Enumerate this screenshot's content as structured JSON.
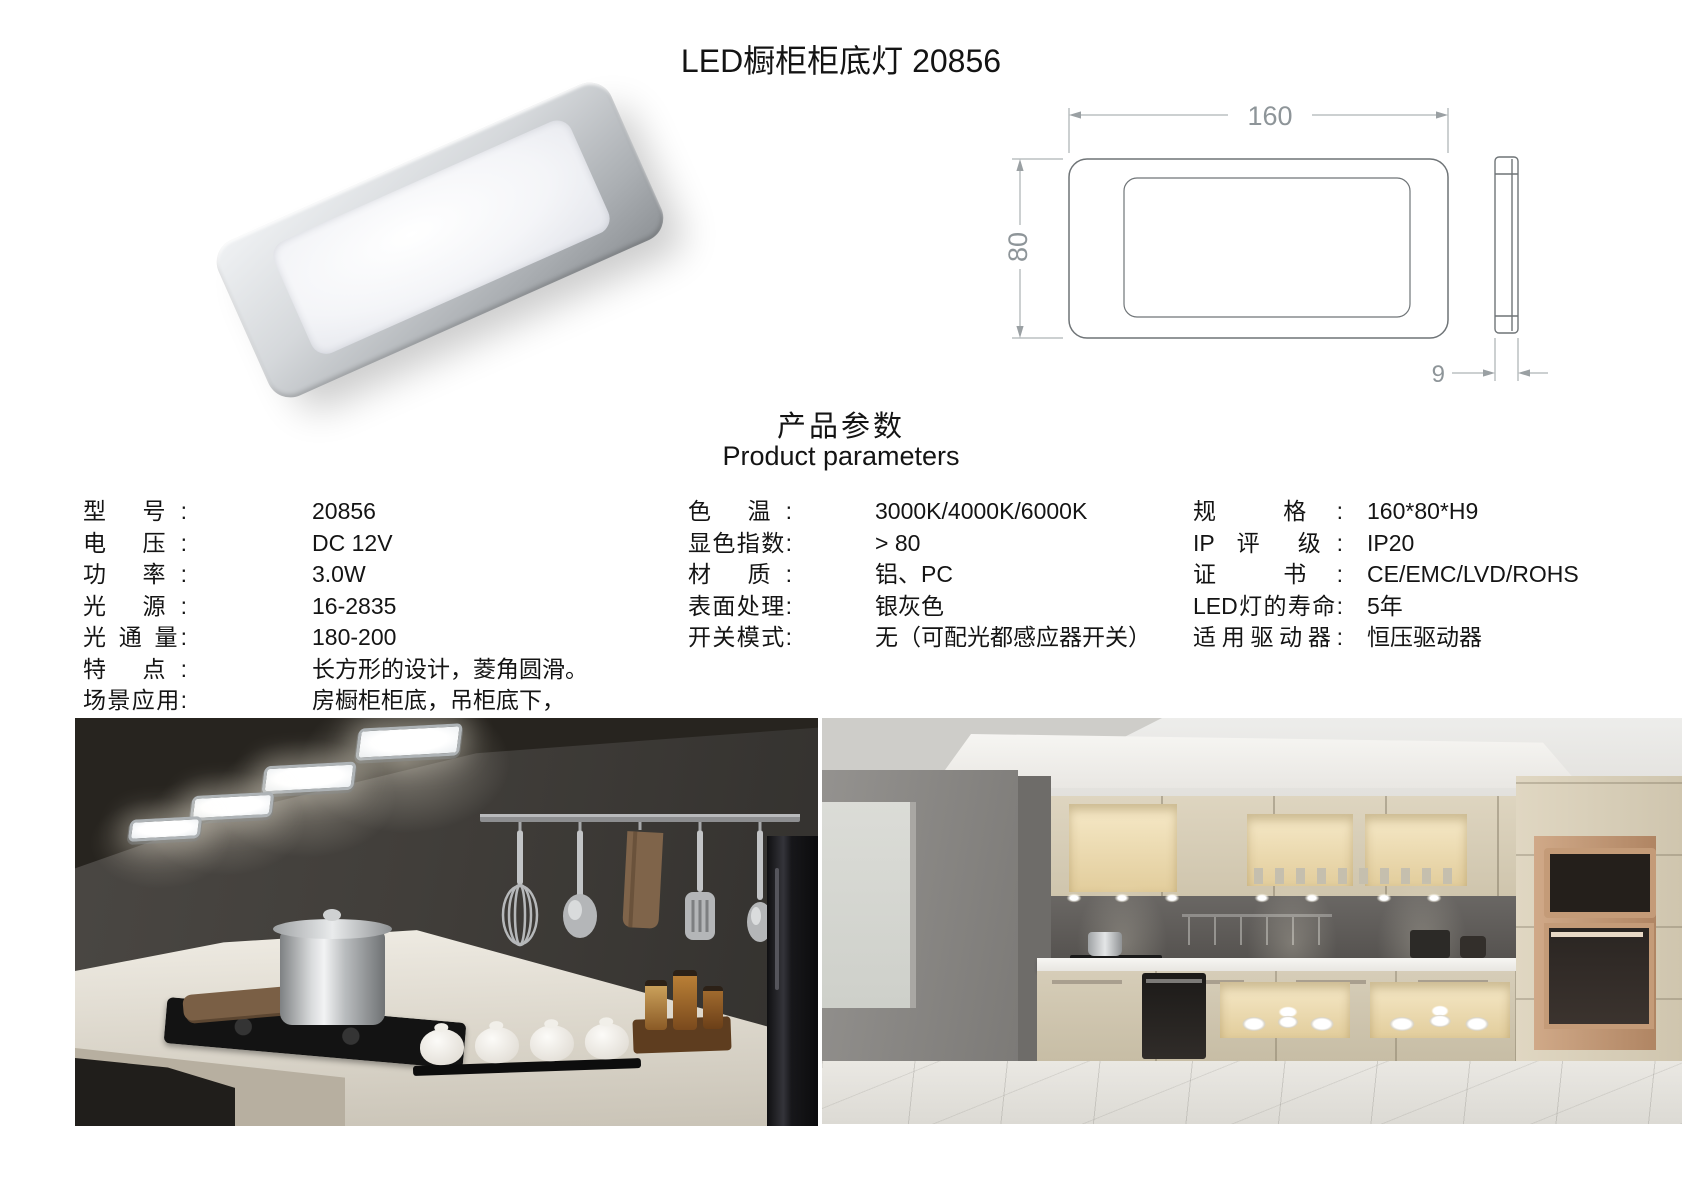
{
  "title": "LED橱柜柜底灯 20856",
  "section": {
    "heading_zh": "产品参数",
    "heading_en": "Product parameters"
  },
  "drawing": {
    "width_dim": "160",
    "height_dim": "80",
    "thickness_dim": "9"
  },
  "specs": {
    "col1": [
      {
        "label": "型 号:",
        "value": "20856"
      },
      {
        "label": "电 压:",
        "value": "DC 12V"
      },
      {
        "label": "功 率:",
        "value": "3.0W"
      },
      {
        "label": "光 源:",
        "value": "16-2835"
      },
      {
        "label": "光 通 量:",
        "value": "180-200"
      },
      {
        "label": "特 点:",
        "value": "长方形的设计，菱角圆滑。"
      },
      {
        "label": "场景应用:",
        "value": "房橱柜柜底，吊柜底下，"
      }
    ],
    "col2": [
      {
        "label": "色 温:",
        "value": "3000K/4000K/6000K"
      },
      {
        "label": "显色指数:",
        "value": "> 80"
      },
      {
        "label": "材 质:",
        "value": "铝、PC"
      },
      {
        "label": "表面处理:",
        "value": "银灰色"
      },
      {
        "label": "开关模式:",
        "value": "无（可配光都感应器开关）"
      }
    ],
    "col3": [
      {
        "label": "规 格:",
        "value": "160*80*H9"
      },
      {
        "label": "IP 评 级:",
        "value": "IP20"
      },
      {
        "label": "证 书:",
        "value": "CE/EMC/LVD/ROHS"
      },
      {
        "label": "LED灯的寿命:",
        "value": "5年"
      },
      {
        "label": "适用驱动器:",
        "value": "恒压驱动器"
      }
    ]
  }
}
